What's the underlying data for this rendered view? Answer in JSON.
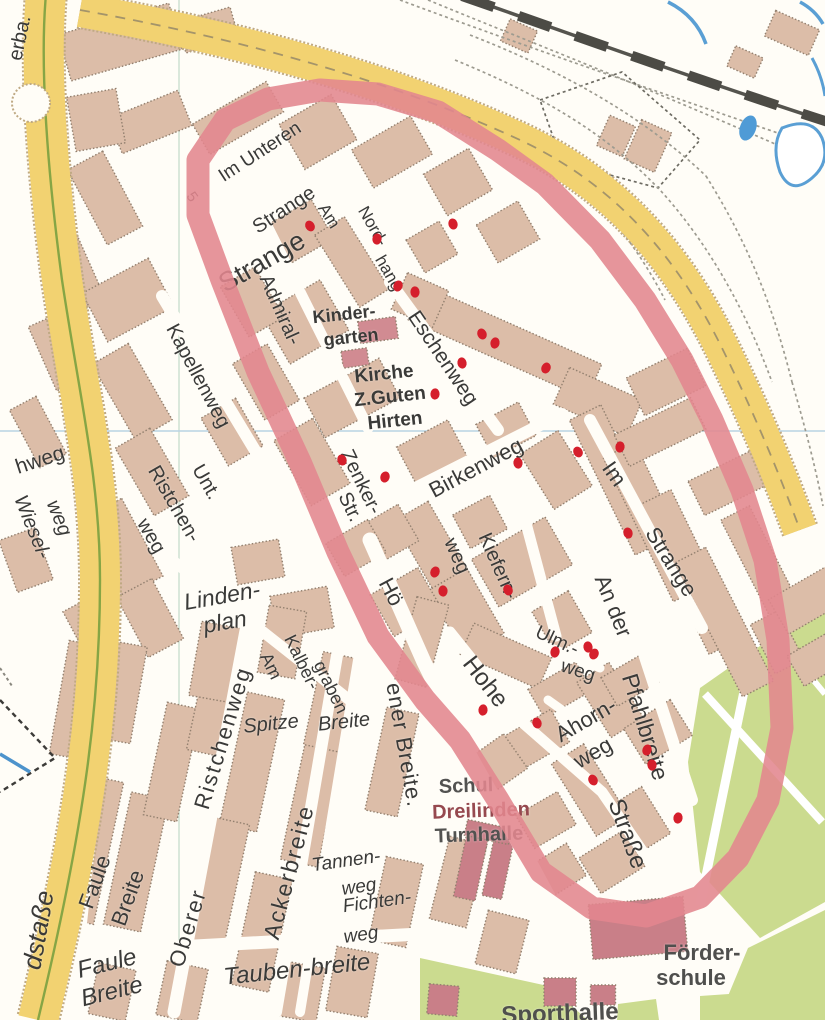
{
  "map_type": "scanned-city-street-map",
  "colors": {
    "background": "#fffdf7",
    "building": "#dcbda8",
    "building_edge": "#93806f",
    "public_building": "#cb8289",
    "road_major": "#f2d271",
    "road_casing": "#bfa983",
    "green_area": "#cbdb8f",
    "water": "#5a9fd4",
    "railway": "#4c4b45",
    "grid_line": "#b9d3e4",
    "highlight_loop": "#e2868e",
    "marker_dot": "#d51f2c",
    "label_dark": "#3a3a38",
    "label_maroon": "#96494f",
    "label_gray_bold": "#525250"
  },
  "labels": [
    {
      "text": "erba.",
      "x": 20,
      "y": 38,
      "rot": -78,
      "size": 20,
      "bold": false
    },
    {
      "text": "5",
      "x": 192,
      "y": 197,
      "rot": 55,
      "size": 15
    },
    {
      "text": "Im Unteren",
      "x": 260,
      "y": 152,
      "rot": -33,
      "size": 19
    },
    {
      "text": "Strange",
      "x": 284,
      "y": 210,
      "rot": -33,
      "size": 20
    },
    {
      "text": "Strange",
      "x": 262,
      "y": 262,
      "rot": -30,
      "size": 27
    },
    {
      "text": "Am",
      "x": 329,
      "y": 216,
      "rot": 58,
      "size": 17
    },
    {
      "text": "Nord-",
      "x": 373,
      "y": 226,
      "rot": 60,
      "size": 17
    },
    {
      "text": "hang",
      "x": 389,
      "y": 273,
      "rot": 60,
      "size": 17
    },
    {
      "text": "Admiral-",
      "x": 280,
      "y": 310,
      "rot": 66,
      "size": 20
    },
    {
      "text": "Kapellenweg",
      "x": 198,
      "y": 376,
      "rot": 62,
      "size": 20
    },
    {
      "text": "Kinder-",
      "x": 344,
      "y": 314,
      "rot": -6,
      "size": 18,
      "bold": true
    },
    {
      "text": "garten",
      "x": 351,
      "y": 337,
      "rot": -6,
      "size": 18,
      "bold": true
    },
    {
      "text": "Kirche",
      "x": 384,
      "y": 374,
      "rot": -6,
      "size": 19,
      "bold": true
    },
    {
      "text": "Z.Guten",
      "x": 390,
      "y": 397,
      "rot": -6,
      "size": 19,
      "bold": true
    },
    {
      "text": "Hirten",
      "x": 395,
      "y": 421,
      "rot": -6,
      "size": 19,
      "bold": true
    },
    {
      "text": "Eschenweg",
      "x": 443,
      "y": 358,
      "rot": 56,
      "size": 21
    },
    {
      "text": "Zenker-",
      "x": 361,
      "y": 482,
      "rot": 64,
      "size": 20
    },
    {
      "text": "Str.",
      "x": 350,
      "y": 507,
      "rot": 64,
      "size": 20
    },
    {
      "text": "Birkenweg",
      "x": 476,
      "y": 468,
      "rot": -28,
      "size": 22
    },
    {
      "text": "Kiefern-",
      "x": 498,
      "y": 566,
      "rot": 66,
      "size": 20
    },
    {
      "text": "weg",
      "x": 457,
      "y": 556,
      "rot": 66,
      "size": 20
    },
    {
      "text": "Im",
      "x": 614,
      "y": 474,
      "rot": 55,
      "size": 22
    },
    {
      "text": "Strange",
      "x": 671,
      "y": 562,
      "rot": 58,
      "size": 22
    },
    {
      "text": "An der",
      "x": 613,
      "y": 606,
      "rot": 68,
      "size": 22
    },
    {
      "text": "Pfahlbreite",
      "x": 645,
      "y": 727,
      "rot": 73,
      "size": 23
    },
    {
      "text": "Hohe",
      "x": 485,
      "y": 682,
      "rot": 52,
      "size": 24
    },
    {
      "text": "Straße",
      "x": 627,
      "y": 834,
      "rot": 70,
      "size": 24
    },
    {
      "text": "Ulm.-",
      "x": 557,
      "y": 641,
      "rot": 25,
      "size": 19
    },
    {
      "text": "weg",
      "x": 578,
      "y": 671,
      "rot": 18,
      "size": 19
    },
    {
      "text": "Ahorn-",
      "x": 586,
      "y": 720,
      "rot": -30,
      "size": 22
    },
    {
      "text": "weg",
      "x": 593,
      "y": 753,
      "rot": -30,
      "size": 22
    },
    {
      "text": "hweg",
      "x": 40,
      "y": 460,
      "rot": -18,
      "size": 21
    },
    {
      "text": "Wiesel-",
      "x": 32,
      "y": 527,
      "rot": 68,
      "size": 20,
      "italic": true
    },
    {
      "text": "weg",
      "x": 59,
      "y": 518,
      "rot": 68,
      "size": 20,
      "italic": true
    },
    {
      "text": "Unt.",
      "x": 206,
      "y": 482,
      "rot": 60,
      "size": 20
    },
    {
      "text": "Ristchen-",
      "x": 174,
      "y": 504,
      "rot": 60,
      "size": 20
    },
    {
      "text": "weg",
      "x": 151,
      "y": 536,
      "rot": 60,
      "size": 20
    },
    {
      "text": "Linden-",
      "x": 222,
      "y": 596,
      "rot": -10,
      "size": 23,
      "italic": true
    },
    {
      "text": "plan",
      "x": 225,
      "y": 622,
      "rot": -10,
      "size": 23,
      "italic": true
    },
    {
      "text": "Am",
      "x": 271,
      "y": 666,
      "rot": 64,
      "size": 18
    },
    {
      "text": "Kalber-",
      "x": 302,
      "y": 662,
      "rot": 64,
      "size": 18
    },
    {
      "text": "graben",
      "x": 331,
      "y": 687,
      "rot": 64,
      "size": 18
    },
    {
      "text": "Spitze",
      "x": 271,
      "y": 724,
      "rot": -6,
      "size": 20,
      "italic": true
    },
    {
      "text": "Breite",
      "x": 344,
      "y": 722,
      "rot": -6,
      "size": 20,
      "italic": true
    },
    {
      "text": "Hö",
      "x": 391,
      "y": 592,
      "rot": 62,
      "size": 22
    },
    {
      "text": "ener Breite.",
      "x": 404,
      "y": 745,
      "rot": 80,
      "size": 22,
      "spacing": 1
    },
    {
      "text": "Oberer",
      "x": 188,
      "y": 928,
      "rot": -73,
      "size": 22,
      "spacing": 2
    },
    {
      "text": "Ristchenweg",
      "x": 223,
      "y": 738,
      "rot": -73,
      "size": 22,
      "spacing": 2
    },
    {
      "text": "Ackerbreite",
      "x": 289,
      "y": 872,
      "rot": -75,
      "size": 23,
      "spacing": 2
    },
    {
      "text": "Tannen-",
      "x": 346,
      "y": 861,
      "rot": -8,
      "size": 19,
      "italic": true
    },
    {
      "text": "weg",
      "x": 359,
      "y": 887,
      "rot": -8,
      "size": 19,
      "italic": true
    },
    {
      "text": "Fichten-",
      "x": 377,
      "y": 902,
      "rot": -8,
      "size": 19,
      "italic": true
    },
    {
      "text": "weg",
      "x": 361,
      "y": 935,
      "rot": -8,
      "size": 19,
      "italic": true
    },
    {
      "text": "Tauben-breite",
      "x": 297,
      "y": 970,
      "rot": -6,
      "size": 24,
      "italic": true
    },
    {
      "text": "Faule",
      "x": 95,
      "y": 882,
      "rot": -70,
      "size": 22
    },
    {
      "text": "Breite",
      "x": 128,
      "y": 898,
      "rot": -70,
      "size": 22
    },
    {
      "text": "Faule",
      "x": 107,
      "y": 964,
      "rot": -14,
      "size": 24,
      "italic": true
    },
    {
      "text": "Breite",
      "x": 112,
      "y": 992,
      "rot": -14,
      "size": 24,
      "italic": true
    },
    {
      "text": "dstaße",
      "x": 38,
      "y": 930,
      "rot": -80,
      "size": 26,
      "italic": true
    },
    {
      "text": "Schul",
      "x": 466,
      "y": 786,
      "rot": -2,
      "size": 20,
      "bold": true,
      "color": "#525250"
    },
    {
      "text": "Dreilinden",
      "x": 481,
      "y": 811,
      "rot": -2,
      "size": 20,
      "bold": true,
      "color": "#96494f"
    },
    {
      "text": "Turnhalle",
      "x": 479,
      "y": 835,
      "rot": -2,
      "size": 20,
      "bold": true,
      "color": "#525250"
    },
    {
      "text": "Förder-",
      "x": 702,
      "y": 953,
      "rot": 0,
      "size": 22,
      "bold": true,
      "color": "#4f4f4d"
    },
    {
      "text": "schule",
      "x": 691,
      "y": 978,
      "rot": 0,
      "size": 22,
      "bold": true,
      "color": "#4f4f4d"
    },
    {
      "text": "Sporthalle",
      "x": 560,
      "y": 1014,
      "rot": -2,
      "size": 24,
      "bold": true,
      "color": "#4f4f4d"
    }
  ],
  "markers": {
    "dot_color": "#d51f2c",
    "dots": [
      [
        310,
        226
      ],
      [
        377,
        239
      ],
      [
        453,
        224
      ],
      [
        398,
        286
      ],
      [
        415,
        292
      ],
      [
        482,
        334
      ],
      [
        495,
        343
      ],
      [
        462,
        363
      ],
      [
        546,
        368
      ],
      [
        435,
        394
      ],
      [
        342,
        460
      ],
      [
        385,
        477
      ],
      [
        518,
        463
      ],
      [
        578,
        452
      ],
      [
        620,
        447
      ],
      [
        628,
        533
      ],
      [
        435,
        572
      ],
      [
        443,
        591
      ],
      [
        508,
        590
      ],
      [
        555,
        652
      ],
      [
        588,
        647
      ],
      [
        594,
        654
      ],
      [
        483,
        710
      ],
      [
        537,
        723
      ],
      [
        647,
        750
      ],
      [
        652,
        765
      ],
      [
        593,
        780
      ],
      [
        678,
        818
      ]
    ],
    "loop_color": "#e2868e",
    "loop_width": 23,
    "loop_points": [
      [
        320,
        90
      ],
      [
        378,
        94
      ],
      [
        438,
        112
      ],
      [
        498,
        150
      ],
      [
        545,
        184
      ],
      [
        600,
        240
      ],
      [
        645,
        300
      ],
      [
        682,
        360
      ],
      [
        712,
        420
      ],
      [
        742,
        490
      ],
      [
        765,
        560
      ],
      [
        778,
        640
      ],
      [
        782,
        728
      ],
      [
        768,
        800
      ],
      [
        738,
        858
      ],
      [
        700,
        897
      ],
      [
        646,
        916
      ],
      [
        592,
        908
      ],
      [
        541,
        872
      ],
      [
        498,
        800
      ],
      [
        460,
        740
      ],
      [
        425,
        700
      ],
      [
        378,
        636
      ],
      [
        338,
        552
      ],
      [
        300,
        462
      ],
      [
        258,
        372
      ],
      [
        222,
        280
      ],
      [
        198,
        215
      ],
      [
        198,
        160
      ],
      [
        225,
        120
      ],
      [
        268,
        99
      ],
      [
        320,
        90
      ]
    ]
  }
}
